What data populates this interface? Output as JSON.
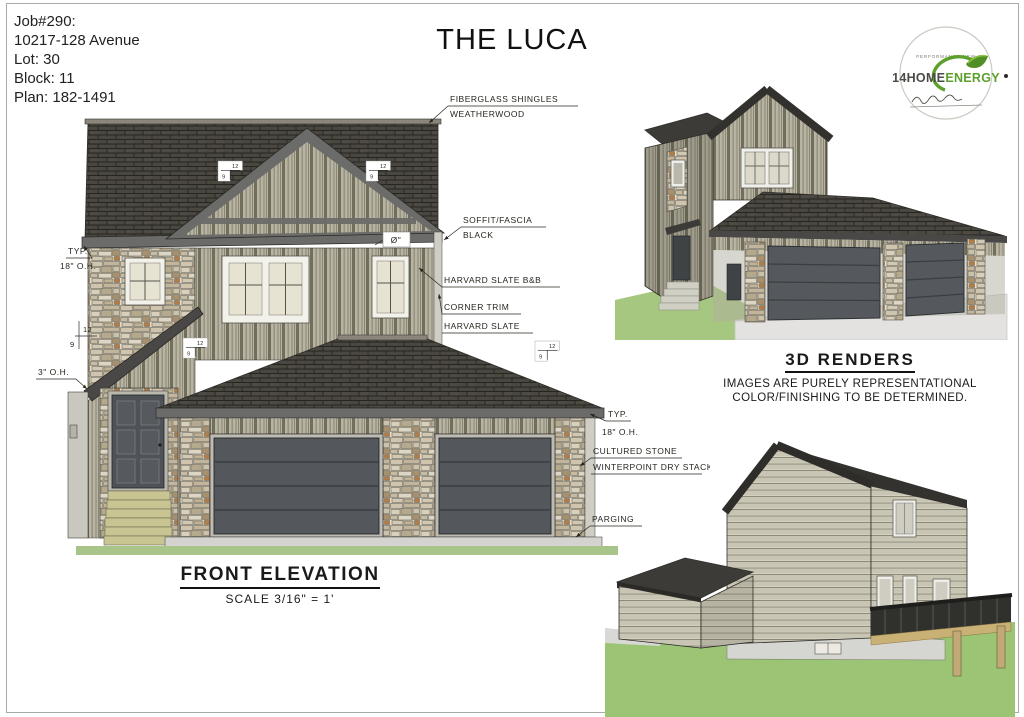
{
  "page": {
    "title": "THE LUCA"
  },
  "job_info": {
    "lines": [
      "Job#290:",
      "10217-128 Avenue",
      "Lot: 30",
      "Block: 11",
      "Plan: 182-1491"
    ]
  },
  "logo": {
    "tagline": "PERFORMANCE NEW",
    "brand_1": "14HOME",
    "brand_2": "ENERGY"
  },
  "elevation": {
    "title": "FRONT ELEVATION",
    "scale": "SCALE 3/16\" = 1'",
    "ann": {
      "shingles_1": "FIBERGLASS SHINGLES",
      "shingles_2": "WEATHERWOOD",
      "soffit_1": "SOFFIT/FASCIA",
      "soffit_2": "BLACK",
      "siding": "HARVARD SLATE B&B",
      "corner_1": "CORNER TRIM",
      "corner_2": "HARVARD SLATE",
      "typ": "TYP.",
      "oh_18": "18\" O.H.",
      "oh_3": "3\" O.H.",
      "stone_1": "CULTURED STONE",
      "stone_2": "WINTERPOINT DRY STACK",
      "parging": "PARGING",
      "pitch_run": "12",
      "pitch_rise": "9",
      "fixture": "Ø\""
    }
  },
  "renders": {
    "title": "3D RENDERS",
    "note_1": "IMAGES ARE PURELY REPRESENTATIONAL",
    "note_2": "COLOR/FINISHING TO BE DETERMINED."
  },
  "colors": {
    "roof": "#4a4741",
    "siding_bnb": "#b7b4a4",
    "stone": "#e3ddcf",
    "door": "#54585c",
    "fascia": "#6b6b69",
    "steps": "#c8c593",
    "grass": "#a6c77f",
    "driveway": "#e3e2e0",
    "lap_siding": "#c9c5b4",
    "logo_green": "#5da02c",
    "ink": "#26261f"
  }
}
